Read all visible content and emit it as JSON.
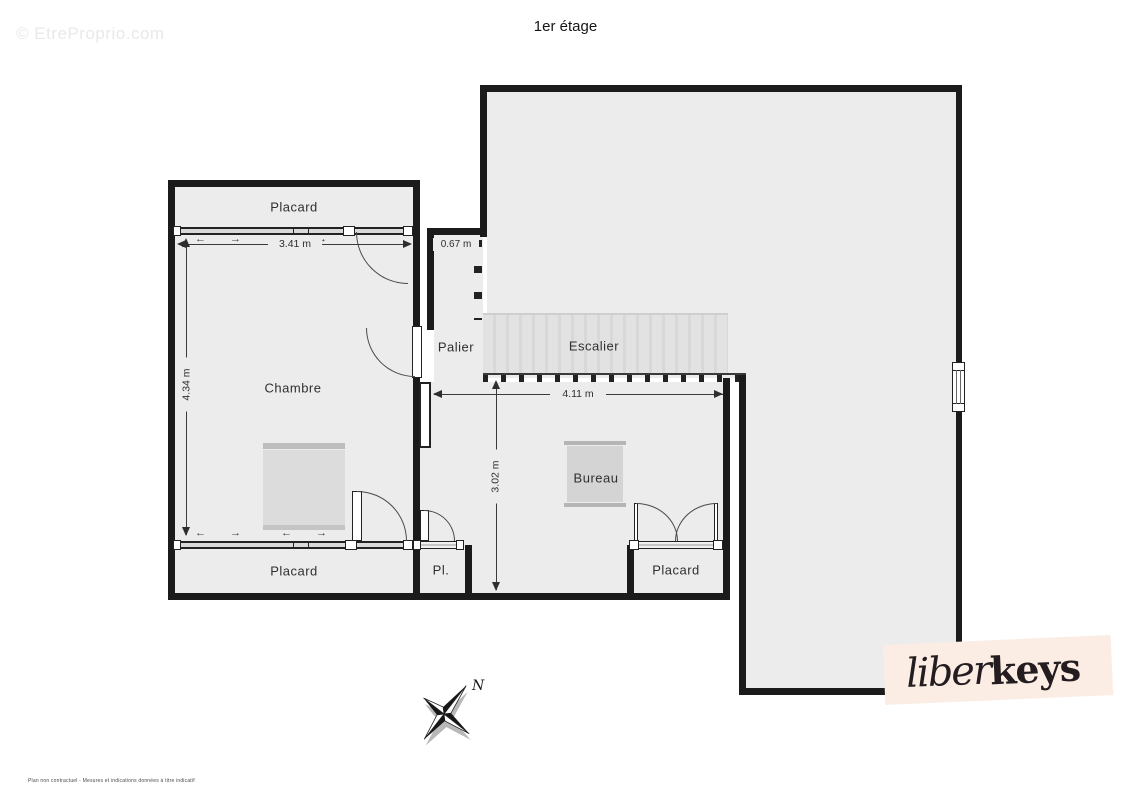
{
  "title": "1er étage",
  "watermark": "© EtreProprio.com",
  "disclaimer": "Plan non contractuel - Mesures et indications données à titre indicatif",
  "logo": {
    "script_part": "liber",
    "bold_part": "keys",
    "background": "#fbece4",
    "text_color": "#241d20"
  },
  "compass": {
    "north_label": "N"
  },
  "rooms": {
    "placard_top": {
      "label": "Placard"
    },
    "chambre": {
      "label": "Chambre"
    },
    "palier": {
      "label": "Palier"
    },
    "escalier": {
      "label": "Escalier"
    },
    "bureau": {
      "label": "Bureau"
    },
    "placard_bottom_left": {
      "label": "Placard"
    },
    "pl_closet": {
      "label": "Pl."
    },
    "placard_bottom_right": {
      "label": "Placard"
    }
  },
  "dimensions": {
    "chambre_width": {
      "label": "3.41 m"
    },
    "palier_width": {
      "label": "0.67 m"
    },
    "chambre_height": {
      "label": "4.34 m"
    },
    "bureau_width": {
      "label": "4.11 m"
    },
    "bureau_height": {
      "label": "3.02 m"
    }
  },
  "icons": {
    "slide_left": "←",
    "slide_right": "→"
  },
  "colors": {
    "wall": "#1b1b1b",
    "floor": "#ececec",
    "stairs": "#e0e0e0",
    "furniture": "#d9d9d9",
    "dimension": "#2e2e2e",
    "logo_bg": "#fbece4"
  }
}
